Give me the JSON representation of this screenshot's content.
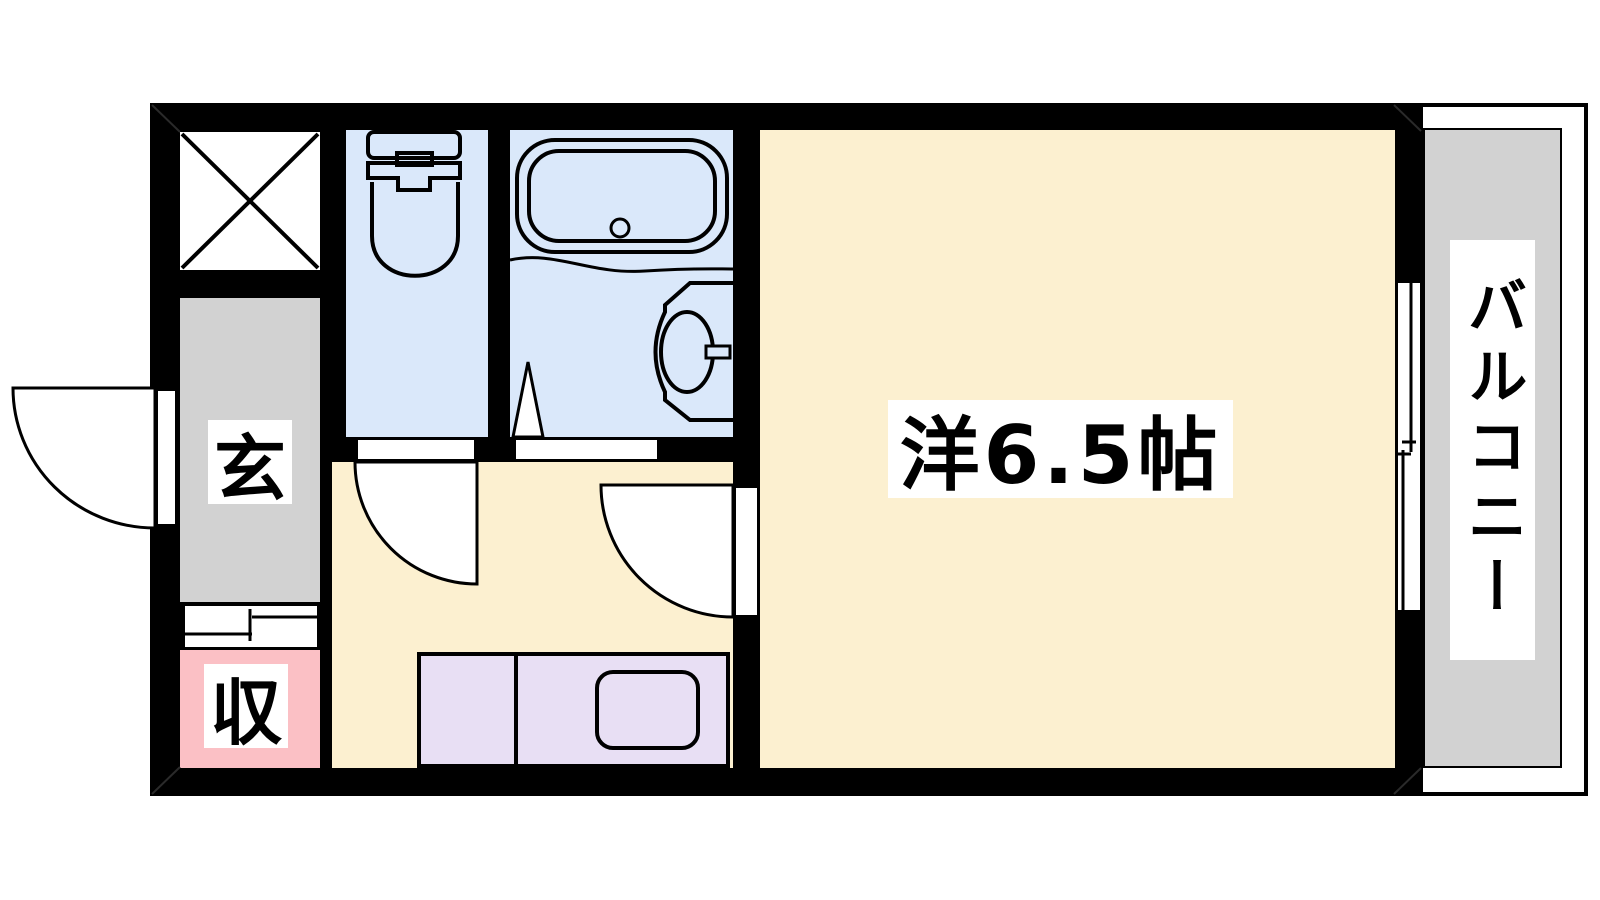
{
  "plan": {
    "type": "apartment-floor-plan",
    "rooms": {
      "western_room": {
        "label": "洋6.5帖"
      },
      "balcony": {
        "label": "バルコニー"
      },
      "entrance": {
        "label": "玄"
      },
      "storage": {
        "label": "収"
      }
    },
    "fixtures": [
      "toilet-icon",
      "bathtub-icon",
      "washbasin-icon",
      "kitchen-sink-icon",
      "pipe-space-x-icon",
      "door-swing-icon",
      "sliding-door-icon",
      "sliding-window-icon"
    ],
    "colors": {
      "room_floor": "#FCF0D0",
      "wet_area": "#DAE8FA",
      "entrance_floor": "#D2D2D2",
      "balcony_floor": "#D2D2D2",
      "storage_floor": "#FBC0C5",
      "kitchen_counter": "#E8DFF4",
      "wall": "#000000",
      "label_bg": "#FFFFFF"
    }
  }
}
